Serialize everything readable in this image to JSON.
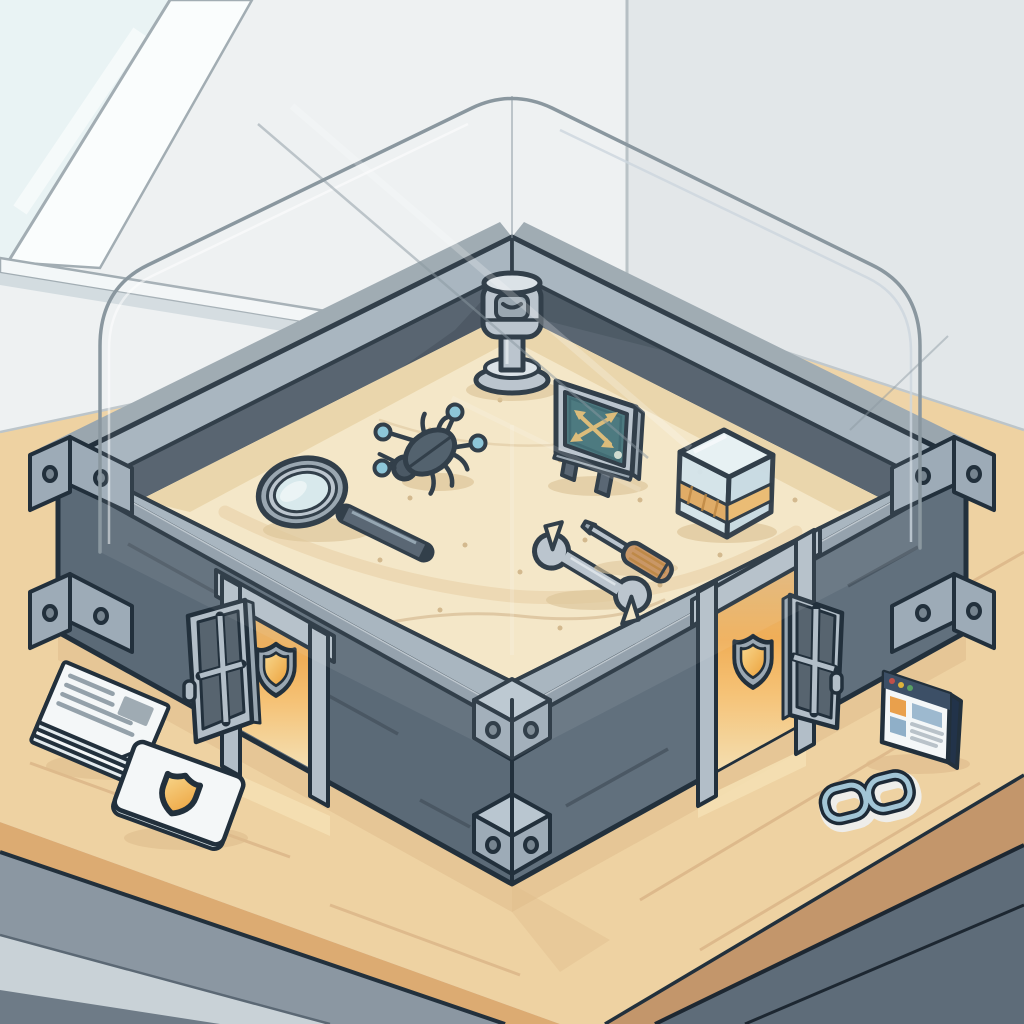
{
  "scene": {
    "description": "Isometric cartoon illustration of a security sandbox: a glass-enclosed sand pit with analysis tools inside, shielded gates in its walls, and security items on a wooden table."
  },
  "objects": [
    {
      "id": "window",
      "label": "room window"
    },
    {
      "id": "table",
      "label": "wooden table"
    },
    {
      "id": "sandbox",
      "label": "metal-walled sandbox"
    },
    {
      "id": "glass-enclosure",
      "label": "transparent glass enclosure"
    },
    {
      "id": "periscope",
      "label": "observation periscope"
    },
    {
      "id": "bug-icon",
      "label": "malware bug with network nodes"
    },
    {
      "id": "magnifying-glass-icon",
      "label": "magnifying glass"
    },
    {
      "id": "monitor-chart",
      "label": "monitor with crossed arrows"
    },
    {
      "id": "glass-container",
      "label": "glass specimen cube with amber band"
    },
    {
      "id": "wrench-icon",
      "label": "wrench"
    },
    {
      "id": "screwdriver-icon",
      "label": "screwdriver"
    },
    {
      "id": "left-gate",
      "label": "left gate with shield"
    },
    {
      "id": "right-gate",
      "label": "right gate with shield"
    },
    {
      "id": "shield-icon",
      "label": "security shield emblem"
    },
    {
      "id": "documents-stack",
      "label": "stack of documents"
    },
    {
      "id": "security-badge-card",
      "label": "card with shield badge"
    },
    {
      "id": "browser-window-icon",
      "label": "browser window"
    },
    {
      "id": "chain-link-icon",
      "label": "chain link"
    }
  ],
  "colors": {
    "outline": "#22303c",
    "white": "#ffffff",
    "wallLeft": "#eef1f2",
    "wallRight": "#e2e7e9",
    "wallCorner": "#b6bfc4",
    "wallEdge": "#bcc5ca",
    "windowGlass": "#e9f3f4",
    "windowFrame": "#fafdfd",
    "windowFrameLine": "#a2adb3",
    "sill": "#f3f7f8",
    "sillShade": "#d3dce0",
    "tableTop": "#eed2a2",
    "plank": "#dcb789",
    "tableEdgeL": "#dcab72",
    "tableEdgeR": "#c3966b",
    "apron": "#8b97a2",
    "apronLine": "#5b6874",
    "floorLight": "#c9d2d7",
    "floorWedge": "#6e7b87",
    "floorDark": "#5e6c79",
    "floorSeam": "#1d2731",
    "shadowTan": "#ddb98a",
    "shadowSand": "#dcc394",
    "glassBase": "#9aa6ae",
    "boxWallL": "#5b6a77",
    "boxWallR": "#61707d",
    "boxSeam": "#46535e",
    "innerWall": "#4c5a66",
    "innerShadow": "#404d59",
    "rimTop": "#a3b1bc",
    "rimLight": "#ccd6dd",
    "rimLip": "#8e9ca8",
    "bracket": "#9dabb7",
    "bracketTop": "#b9c6d0",
    "boltFill": "#76848f",
    "sand": "#f5e7c5",
    "sandShade": "#e9d2a2",
    "sandSpeckle": "#c2a06c",
    "sandLine": "#d8bd92",
    "duneWide": "#e6cb9c",
    "glassLine": "#8a979f",
    "metal": "#b7c2cb",
    "metalHi": "#d9e1e7",
    "metalShade": "#93a1ac",
    "steelHi": "#8ea0ad",
    "darkSteel": "#4e5c6a",
    "lens": "#d6e9ec",
    "lensHi": "#eef7f8",
    "teal": "#3f7077",
    "tealDark": "#33616a",
    "arrowGold": "#d9b871",
    "paleDot": "#cdd9ce",
    "cubeTop": "#e6f1f4",
    "cubeLeft": "#d2e3eb",
    "cubeRight": "#c5d9e3",
    "amber": "#dfa65c",
    "amberHi": "#eab86b",
    "amberDark": "#b97f35",
    "glowTop": "#dfb87e",
    "glowMid": "#f0ae57",
    "glowBright": "#f5c276",
    "glowFloor": "#f4e0b4",
    "gateMetal": "#b2bec8",
    "gateSide": "#97a5b0",
    "doorPane": "#57646f",
    "shieldRing": "#9aa7b2",
    "shieldGoldHi": "#f8d88e",
    "shieldGold": "#eca03a",
    "nodeBlue": "#85c3d6",
    "bugBody": "#465663",
    "bugHead": "#3d4c59",
    "paper": "#f4f7f8",
    "paperShade": "#e2eaee",
    "paperEdge": "#cfdade",
    "paperLine": "#94a1aa",
    "imgBlock": "#9fabb3",
    "browserBar": "#3c4f66",
    "browserSide": "#22334a",
    "browserOrange": "#e9a04c",
    "browserBlue": "#8fafc8",
    "browserBlue2": "#9db9cf",
    "browserLine": "#b9c2c9",
    "dotRed": "#c0504a",
    "dotYellow": "#ddb23c",
    "dotGreen": "#58a063",
    "linkDark": "#1d2a37",
    "linkBlue": "#a2c5d6",
    "halo": "#eef1f2"
  }
}
